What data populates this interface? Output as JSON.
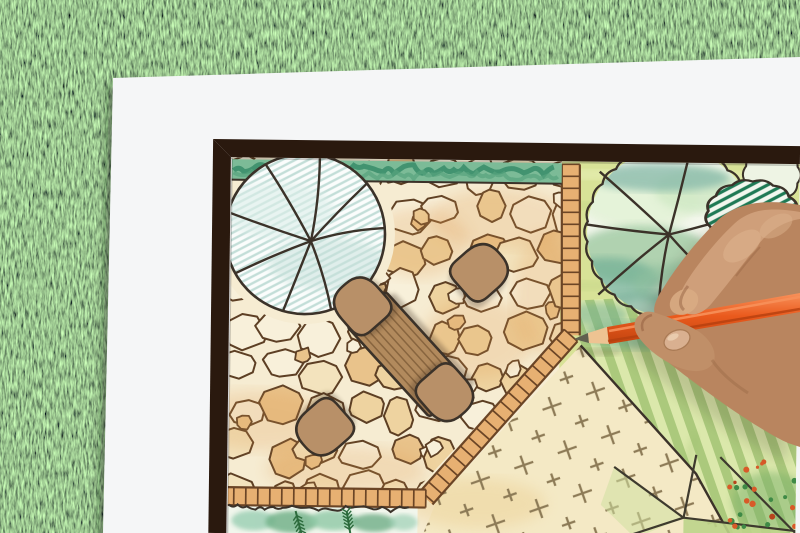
{
  "scene": {
    "subject": "hand drawing a backyard garden landscape plan with an orange colored pencil",
    "setting": "white paper sheet lying on green grass lawn"
  },
  "plan": {
    "elements": [
      "flagstone patio",
      "rectangular wooden dining table",
      "four patio chairs",
      "large round shade tree symbol (hatched)",
      "clipped hedge strip",
      "brick edging band",
      "round tree symbol with scalloped canopy",
      "hatched shrub",
      "striped lawn",
      "gravel area with cross marks",
      "low planting bed",
      "corner flower bed"
    ]
  },
  "palette": {
    "grassBase": "#47743a",
    "paper": "#f5f6f7",
    "frame": "#2a190e",
    "ink": "#3b3229",
    "stoneBase": "#f6ecd2",
    "stoneOutline": "#5d3f24",
    "stoneFill1": "#f8f0da",
    "stoneFill2": "#f3e3bd",
    "stoneFill3": "#eed3a0",
    "stoneFill4": "#e9c38b",
    "stoneTint": "#e09a4f",
    "brickFill": "#e7b072",
    "brickLine": "#6b4526",
    "hedgeBase": "#7cbb97",
    "hedgeDark": "#2f8563",
    "treeFill": "#fbfdfc",
    "treeHatch": "#b9d8d2",
    "gardenBg": "#d8e297",
    "rtreeFill": "#f3f7ec",
    "shrubHatch": "#1f7a55",
    "lawnLight": "#dbe8ab",
    "lawnDark": "#abc97c",
    "gravel": "#f4e9c5",
    "gravelMark": "#8d7b57",
    "bedWash1": "#9ed0b5",
    "bedWash2": "#74b38b",
    "conifer": "#2c6b3c",
    "flowerOrange": "#d85a28",
    "flowerGreen": "#3f8a46",
    "tableWood": "#b28a5d",
    "tableLine": "#84613c",
    "chairWood": "#b89068",
    "timber": "#dcab66",
    "pencil": "#ea5a1d",
    "pencilHi": "#f8915a",
    "pencilDark": "#b5400f",
    "pencilWood": "#eec392",
    "pencilLead": "#60604f",
    "skinLight": "#cfa07b",
    "skinMid": "#b9855f",
    "skinDark": "#8f5c3b",
    "nail": "#d9b090",
    "shadow": "#20150c"
  }
}
